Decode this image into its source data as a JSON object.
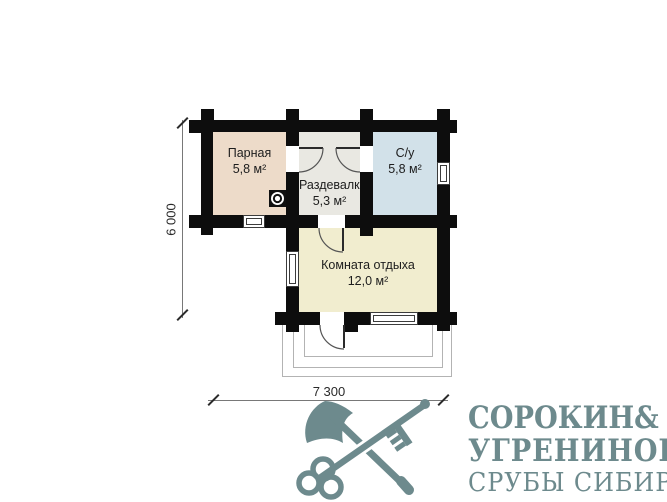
{
  "plan": {
    "rooms": [
      {
        "id": "parnaya",
        "label": "Парная",
        "area": "5,8 м²",
        "color": "#eddbc9",
        "style": "background:#eddbc9"
      },
      {
        "id": "razdevalka",
        "label": "Раздевалка",
        "area": "5,3 м²",
        "color": "#e9e8e2",
        "style": "background:#e9e8e2"
      },
      {
        "id": "su",
        "label": "С/у",
        "area": "5,8 м²",
        "color": "#d2e1e9",
        "style": "background:#d2e1e9"
      },
      {
        "id": "komnata_otdyha",
        "label": "Комната отдыха",
        "area": "12,0 м²",
        "color": "#f1edcf",
        "style": "background:#f1edcf"
      }
    ],
    "wall_color": "#0d0d0d",
    "dim_height": {
      "label": "6 000"
    },
    "dim_width": {
      "label": "7 300"
    }
  },
  "logo": {
    "color": "#6d8a8d",
    "line1_name": "СОРОКИН",
    "line1_amp": "&",
    "line2_name": "УГРЕНИНОВ",
    "tagline": "СРУБЫ СИБИРИ"
  }
}
